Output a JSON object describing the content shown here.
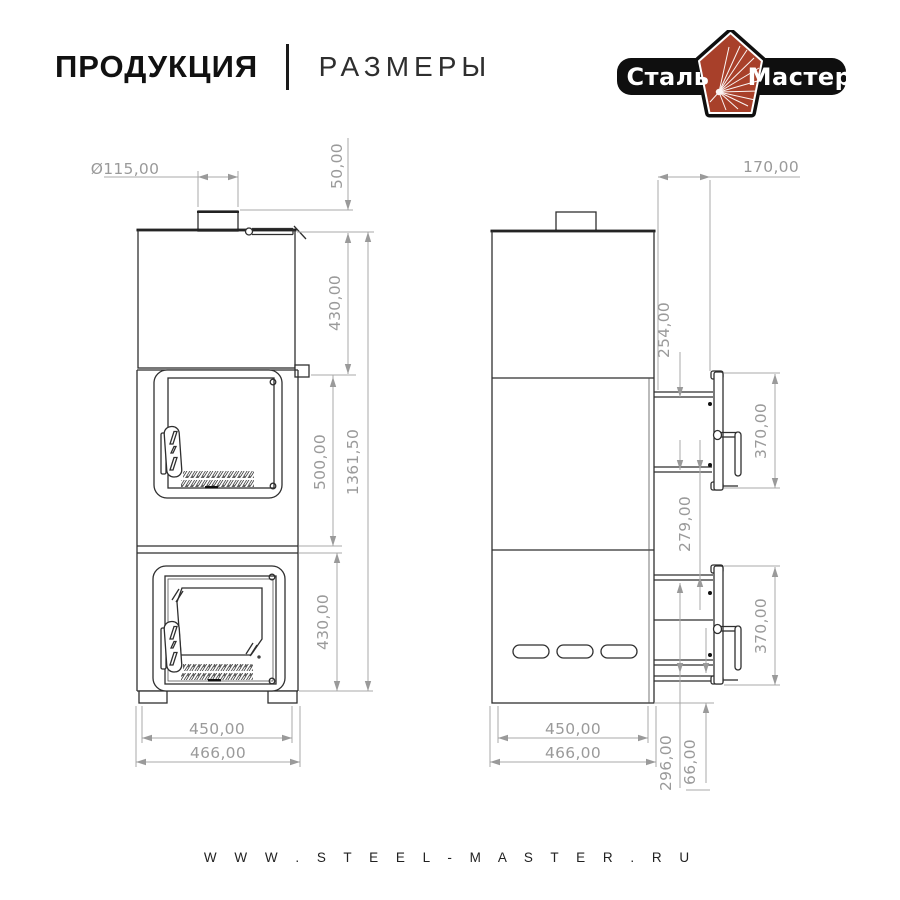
{
  "header": {
    "title": "ПРОДУКЦИЯ",
    "subtitle": "РАЗМЕРЫ"
  },
  "logo": {
    "text_left": "Сталь",
    "text_right": "Мастер",
    "band_color": "#0f0f0f",
    "pentagon_color": "#a8402a",
    "spark_color": "#ffffff"
  },
  "footer": {
    "website": "W W W . S T E E L - M A S T E R . R U"
  },
  "drawing": {
    "front_view": {
      "name": "stove front view",
      "dims": {
        "diameter": "Ø115,00",
        "pipe_height": "50,00",
        "top_section": "430,00",
        "middle_section": "500,00",
        "bottom_section": "430,00",
        "total_height": "1361,50",
        "width_inner": "450,00",
        "width_outer": "466,00"
      }
    },
    "side_view": {
      "name": "stove side view",
      "dims": {
        "handle_offset": "170,00",
        "door_top_offset": "254,00",
        "upper_door_height": "370,00",
        "doors_gap": "279,00",
        "lower_door_height": "370,00",
        "depth_inner": "450,00",
        "depth_outer": "466,00",
        "bottom_span": "296,00",
        "floor_clearance": "66,00"
      }
    }
  }
}
